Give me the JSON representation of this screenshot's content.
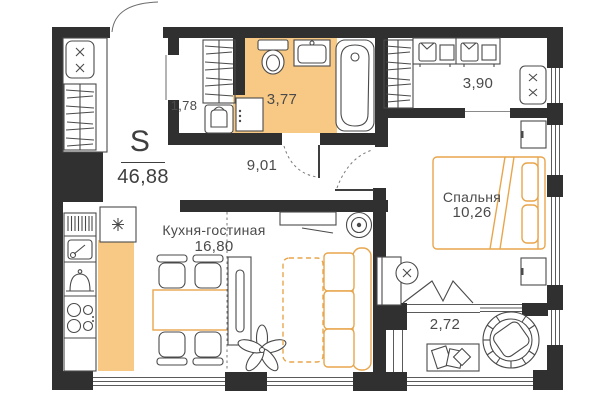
{
  "colors": {
    "wall": "#303030",
    "floor_accent": "#F7C985",
    "furniture_accent": "#E8A64C",
    "line": "#4a4a4a"
  },
  "areas": {
    "total_symbol": "S",
    "total_value": "46,88",
    "hall": "9,01",
    "storage": "1,78",
    "bathroom": "3,77",
    "wardrobe": "3,90",
    "loggia": "2,72",
    "bedroom": {
      "name": "Спальня",
      "value": "10,26"
    },
    "kitchen_living": {
      "name": "Кухня-гостиная",
      "value": "16,80"
    }
  }
}
